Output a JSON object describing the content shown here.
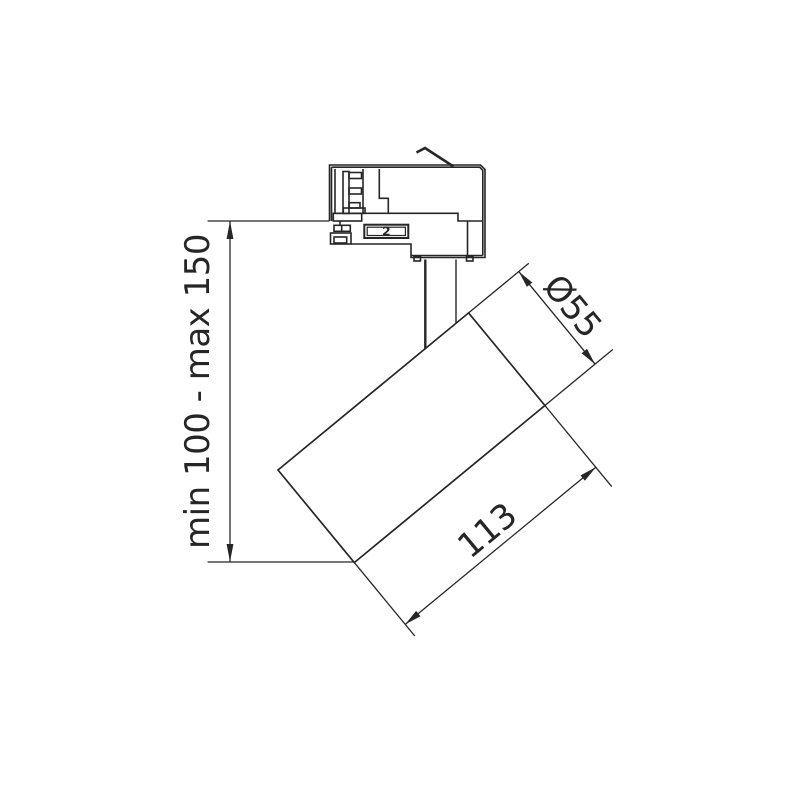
{
  "page": {
    "background_color": "#ffffff"
  },
  "drawing": {
    "type": "technical-dimension-drawing",
    "subject": "track-mounted spotlight, side view",
    "line_color": "#262626",
    "labels": {
      "height_range": "min 100 - max 150",
      "diameter": "Ø55",
      "length": "113",
      "adapter_marking": "2"
    }
  }
}
